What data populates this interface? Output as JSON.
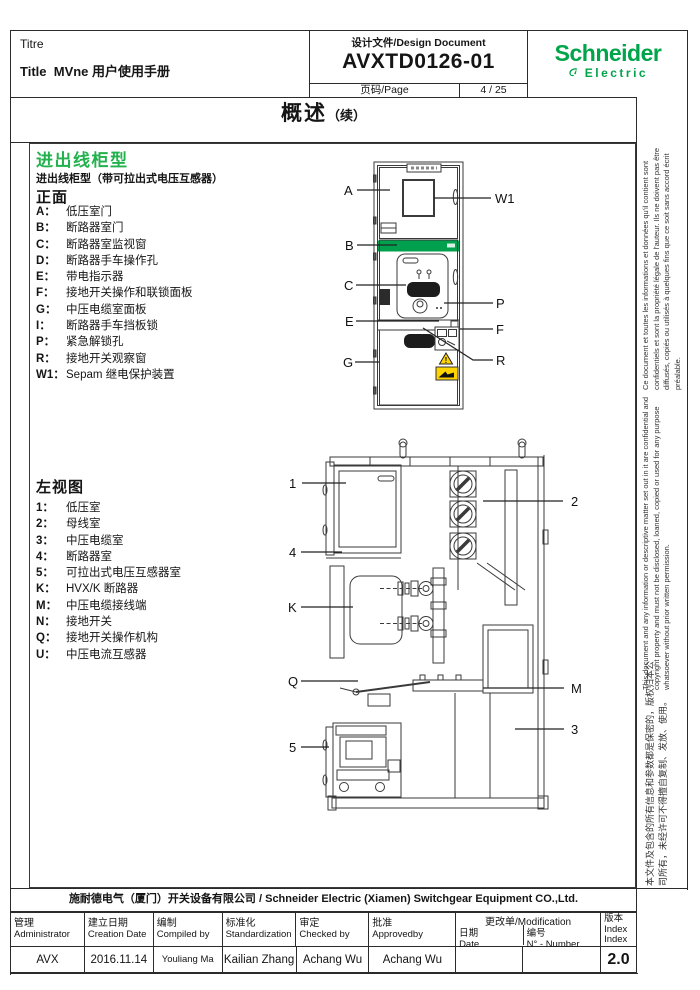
{
  "header": {
    "titre": "Titre",
    "title_key": "Title",
    "title_value": "MVne 用户使用手册",
    "design_label": "设计文件/Design Document",
    "doc_number": "AVXTD0126-01",
    "page_label": "页码/Page",
    "page_value": "4 / 25",
    "brand_line1": "Schneider",
    "brand_line2": "Electric",
    "brand_color": "#00A44A"
  },
  "title_bar": {
    "main": "概述",
    "suffix": "（续）"
  },
  "section": {
    "heading": "进出线柜型",
    "heading_color": "#22B14C",
    "subheading": "进出线柜型（带可拉出式电压互感器）"
  },
  "front_view": {
    "heading": "正面",
    "items": [
      {
        "k": "A：",
        "t": "低压室门"
      },
      {
        "k": "B：",
        "t": "断路器室门"
      },
      {
        "k": "C：",
        "t": "断路器室监视窗"
      },
      {
        "k": "D：",
        "t": "断路器手车操作孔"
      },
      {
        "k": "E：",
        "t": "带电指示器"
      },
      {
        "k": "F：",
        "t": "接地开关操作和联锁面板"
      },
      {
        "k": "G：",
        "t": "中压电缆室面板"
      },
      {
        "k": "I：",
        "t": "断路器手车挡板锁"
      },
      {
        "k": "P：",
        "t": "紧急解锁孔"
      },
      {
        "k": "R：",
        "t": "接地开关观察窗"
      },
      {
        "k": "W1：",
        "t": "Sepam 继电保护装置"
      }
    ],
    "callouts": [
      "A",
      "W1",
      "B",
      "C",
      "P",
      "E",
      "F",
      "G",
      "R"
    ]
  },
  "side_view": {
    "heading": "左视图",
    "items": [
      {
        "k": "1：",
        "t": "低压室"
      },
      {
        "k": "2：",
        "t": "母线室"
      },
      {
        "k": "3：",
        "t": "中压电缆室"
      },
      {
        "k": "4：",
        "t": "断路器室"
      },
      {
        "k": "5：",
        "t": "可拉出式电压互感器室"
      },
      {
        "k": "K：",
        "t": "HVX/K 断路器"
      },
      {
        "k": "M：",
        "t": "中压电缆接线端"
      },
      {
        "k": "N：",
        "t": "接地开关"
      },
      {
        "k": "Q：",
        "t": "接地开关操作机构"
      },
      {
        "k": "U：",
        "t": "中压电流互感器"
      }
    ],
    "callouts": [
      "1",
      "2",
      "4",
      "K",
      "Q",
      "M",
      "3",
      "5"
    ]
  },
  "side_notes": {
    "fr": "Ce document et toutes les informations et données qu'il contient sont confidentiels et sont la propriété légale de l'auteur. Ils ne doivent pas être diffusés, copiés ou utilisés à quelques fins que ce soit sans accord écrit préalable.",
    "en": "This document and any information or descriptive matter set out in it are confidential and copyright property and must not be disclosed, loaned, copied or used for any purpose whatsoever without prior written permission.",
    "zh": "本文件及包含的所有信息和参数都是保密的，版权归本公司所有，未经许可不得擅自复制、发放、使用。"
  },
  "footer": {
    "company": "施耐德电气（厦门）开关设备有限公司 / Schneider Electric (Xiamen)  Switchgear Equipment CO.,Ltd.",
    "cols": [
      {
        "zh": "管理",
        "en": "Administrator",
        "val": "AVX"
      },
      {
        "zh": "建立日期",
        "en": "Creation Date",
        "val": "2016.11.14"
      },
      {
        "zh": "编制",
        "en": "Compiled by",
        "val": "Youliang Ma"
      },
      {
        "zh": "标准化",
        "en": "Standardization",
        "val": "Kailian Zhang"
      },
      {
        "zh": "审定",
        "en": "Checked by",
        "val": "Achang Wu"
      },
      {
        "zh": "批准",
        "en": "Approvedby",
        "val": "Achang Wu"
      }
    ],
    "modification": {
      "header": "更改单/Modification",
      "date_zh": "日期",
      "date_en": "Date",
      "date_val": "",
      "num_zh": "编号",
      "num_en": "N° - Number",
      "num_val": ""
    },
    "index": {
      "zh": "版本",
      "en1": "Index",
      "en2": "Index",
      "val": "2.0"
    }
  }
}
